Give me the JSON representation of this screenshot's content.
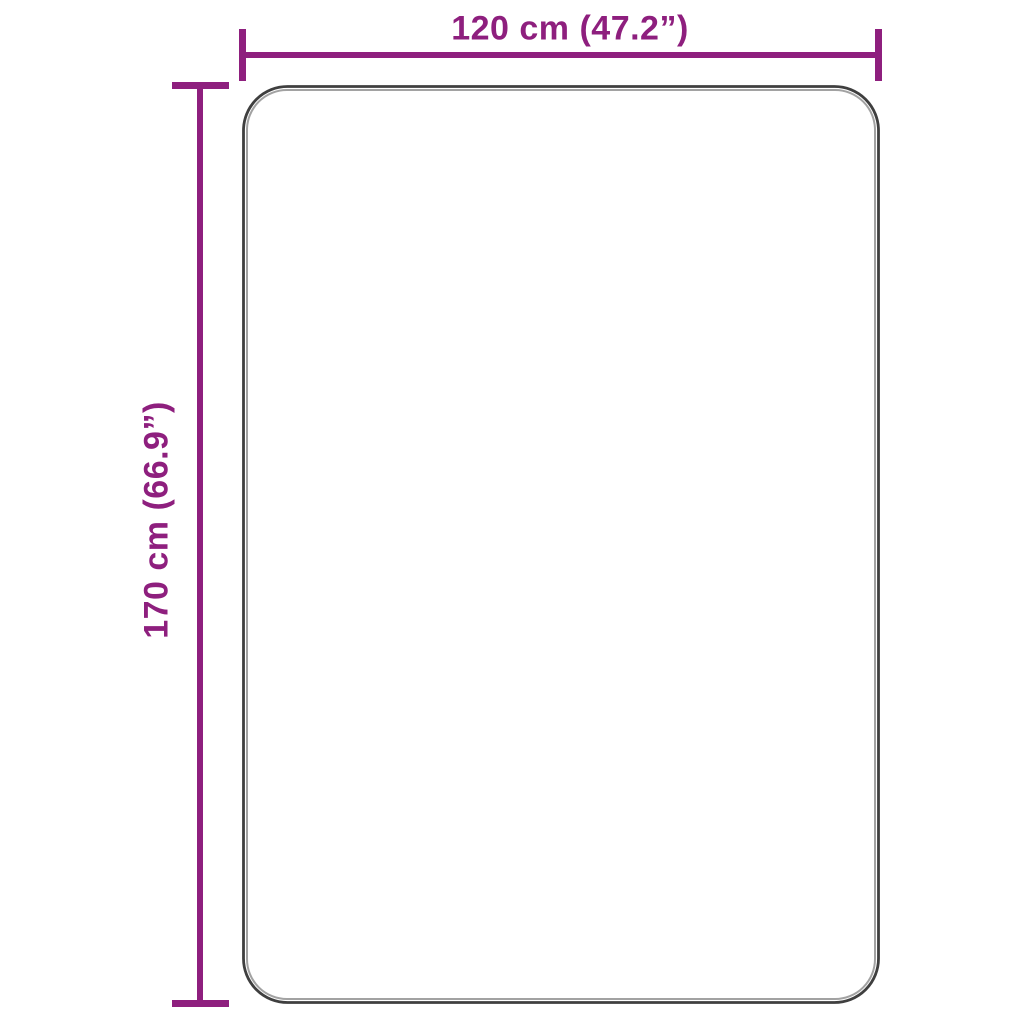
{
  "diagram": {
    "kind": "product-dimension-diagram",
    "background_color": "#ffffff",
    "dimension_color": "#8e1f7e",
    "outline_color": "#3f3f3f",
    "outline_highlight_color": "#a2a2a2",
    "width_dimension": {
      "label": "120 cm (47.2”)",
      "value_cm": "120",
      "value_inches": "47.2"
    },
    "height_dimension": {
      "label": "170 cm (66.9”)",
      "value_cm": "170",
      "value_inches": "66.9"
    }
  }
}
